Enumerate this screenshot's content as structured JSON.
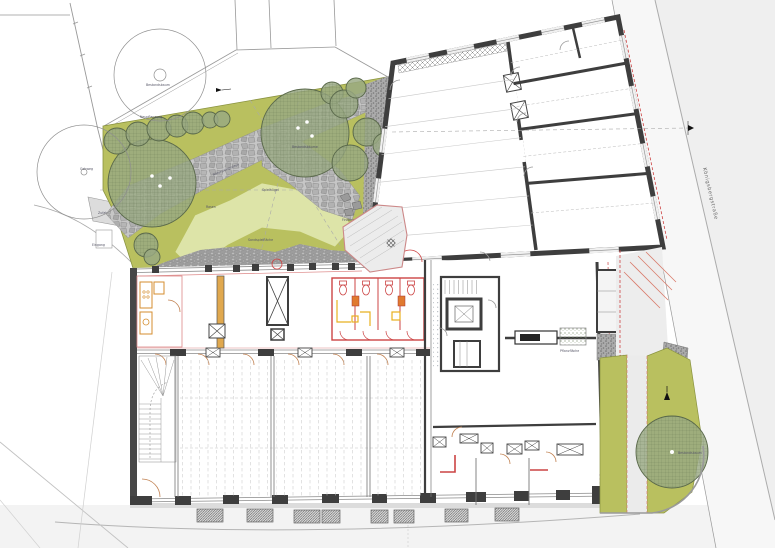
{
  "street": {
    "name": "Königsbergstraße"
  },
  "labels": {
    "big_tree_top": "Bestandsbaum",
    "garden": [
      "Neupflanzung",
      "Bestandsbäume",
      "Natursteinplatten",
      "Rasen",
      "Spielhügel",
      "Sandspielfläche",
      "Findlinge",
      "Holzterrasse",
      "Pflanzfläche",
      "Bestandsbaum"
    ],
    "left": [
      "Gehweg",
      "Zufahrt",
      "Eingang"
    ]
  },
  "colors": {
    "lawn": "#b9c05f",
    "play_lawn": "#dde4a8",
    "tree_canopy": "#99a883",
    "flagstone": "#b0b0b0",
    "wall_dark": "#3e3e3e",
    "new_construction_red": "#cc4444",
    "fixture_orange": "#e0a84e",
    "door_arc": "#c08050",
    "street_surface": "#efefef",
    "sidewalk": "#f3f3f3",
    "purple_marking": "#9a4fc0"
  }
}
